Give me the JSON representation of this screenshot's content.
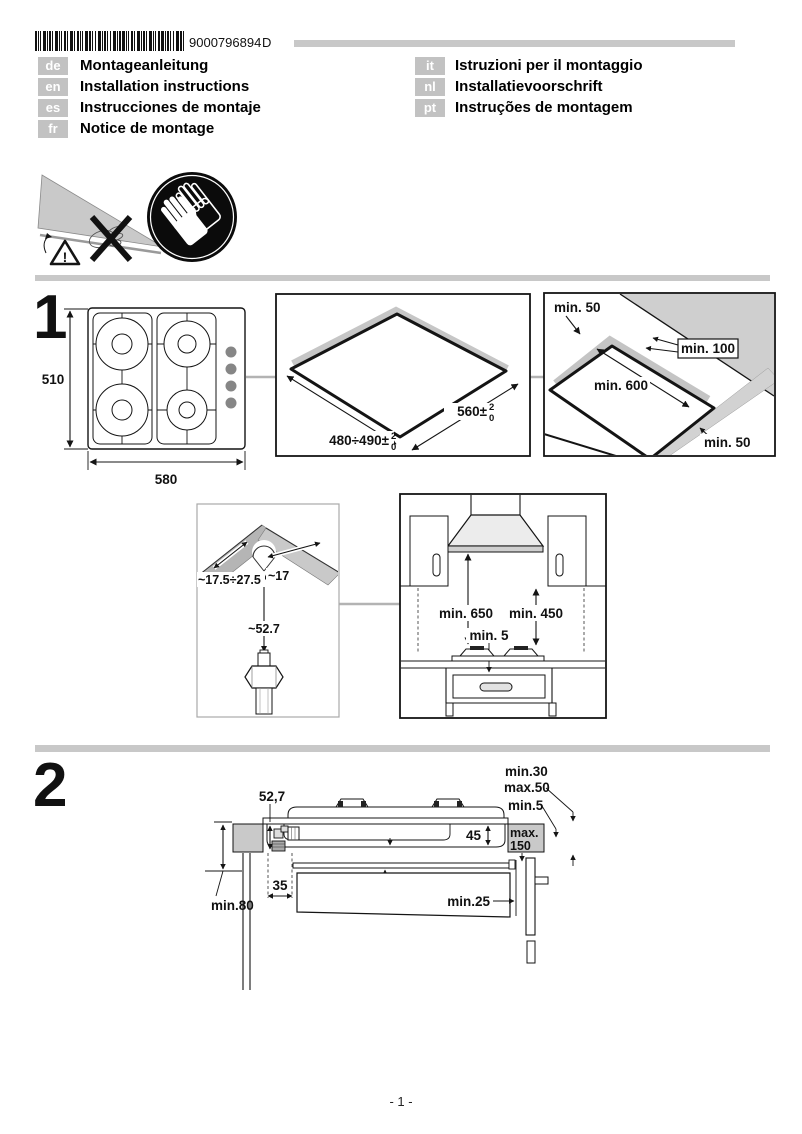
{
  "header": {
    "barcode_number": "9000796894",
    "revision": "D",
    "languages_left": [
      {
        "code": "de",
        "label": "Montageanleitung"
      },
      {
        "code": "en",
        "label": "Installation instructions"
      },
      {
        "code": "es",
        "label": "Instrucciones de montaje"
      },
      {
        "code": "fr",
        "label": "Notice de montage"
      }
    ],
    "languages_right": [
      {
        "code": "it",
        "label": "Istruzioni per il montaggio"
      },
      {
        "code": "nl",
        "label": "Installatievoorschrift"
      },
      {
        "code": "pt",
        "label": "Instruções de montagem"
      }
    ]
  },
  "warnings": {
    "exclamation": "!"
  },
  "section1": {
    "number": "1",
    "hob_depth": "510",
    "hob_width": "580",
    "cutout_depth": "480÷490±",
    "cutout_depth_tol_sup": "2",
    "cutout_depth_tol_sub": "0",
    "cutout_width": "560±",
    "cutout_width_tol_sup": "2",
    "cutout_width_tol_sub": "0",
    "clearance_rear": "min. 50",
    "clearance_wall": "min. 100",
    "clearance_front": "min. 600",
    "clearance_side": "min. 50",
    "corner_a": "~17.5÷27.5",
    "corner_b": "~17",
    "corner_c": "~52.7",
    "hood_clearance": "min. 650",
    "cabinet_clearance": "min. 450",
    "gap_below": "min. 5"
  },
  "section2": {
    "number": "2",
    "worktop_thickness_min": "min.30",
    "worktop_thickness_max": "max.50",
    "side_gap": "min.5",
    "connection_height": "52,7",
    "body_depth": "45",
    "shelf_depth_line1": "max.",
    "shelf_depth_line2": "150",
    "pipe_offset": "35",
    "shelf_gap": "min.10",
    "rear_gap": "min.25",
    "pipe_clearance": "min.80"
  },
  "footer": {
    "page_number": "- 1 -"
  },
  "colors": {
    "accent_gray": "#c8c8c8",
    "worktop_gray": "#c9c9c9",
    "line": "#141414"
  }
}
